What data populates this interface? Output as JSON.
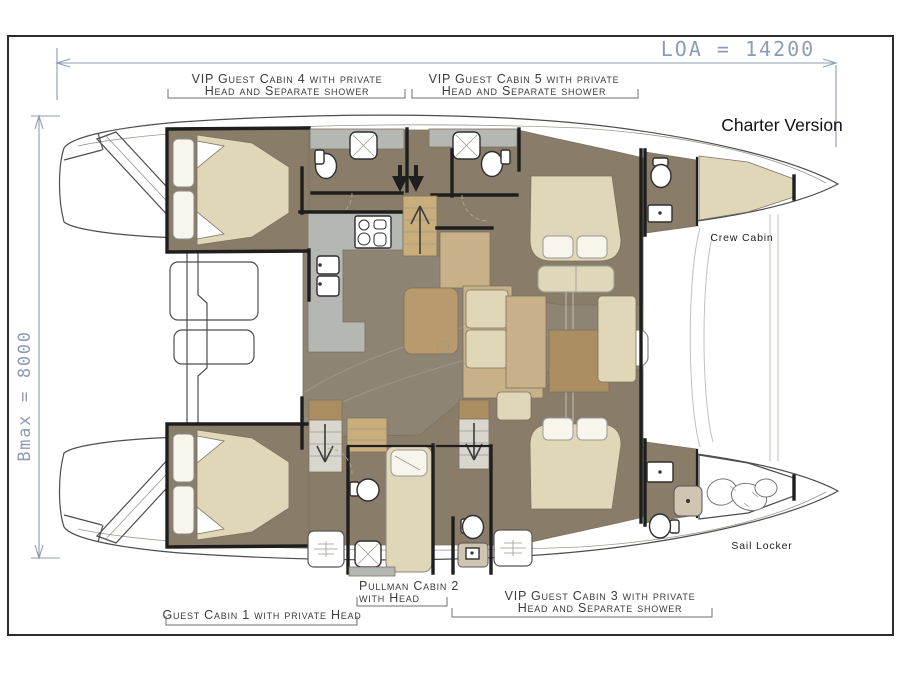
{
  "window": {
    "title": "Charter Version"
  },
  "dimensions": {
    "loa_label": "LOA = 14200",
    "bmax_label": "Bmax = 8000"
  },
  "cabins": {
    "vip4": {
      "line1": "VIP Guest Cabin 4 with private",
      "line2": "Head and Separate shower"
    },
    "vip5": {
      "line1": "VIP Guest Cabin 5 with private",
      "line2": "Head and Separate shower"
    },
    "guest1": {
      "line1": "Guest Cabin 1 with private Head"
    },
    "pullman2": {
      "line1": "Pullman Cabin 2",
      "line2": "with Head"
    },
    "vip3": {
      "line1": "VIP Guest Cabin 3 with private",
      "line2": "Head and Separate shower"
    }
  },
  "areas": {
    "crew_cabin": "Crew Cabin",
    "sail_locker": "Sail Locker"
  },
  "colors": {
    "wall": "#1e1e1e",
    "hullline": "#4d4d4d",
    "floor": "#897d69",
    "salonfloor": "#8e8473",
    "bed": "#e0d6b8",
    "tan": "#c8b189",
    "tandark": "#aa8e61",
    "counter": "#b5b7b3",
    "dim": "#8d9cb4",
    "label": "#3b3b3b",
    "title": "#111111"
  }
}
